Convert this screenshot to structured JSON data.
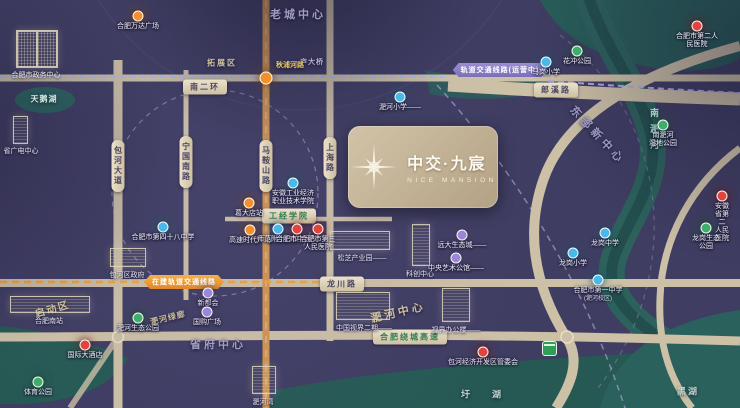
{
  "project": {
    "name_cn": "中交·九宸",
    "name_en": "NICE MANSION"
  },
  "colors": {
    "background": "#3F3D62",
    "road": "#CCC0A6",
    "metro_road": "#D2954E",
    "river": "#2C615C",
    "school": "#4AB8E8",
    "hospital": "#E0443C",
    "park": "#3FAE6A",
    "metro": "#F2912C",
    "commerce": "#9B86D8",
    "mall": "#F2912C",
    "hotel": "#E0443C",
    "logo_bg": "#C4B497"
  },
  "district_labels": [
    {
      "text": "老城中心",
      "x": 298,
      "y": 14,
      "size": 11,
      "ls": 3,
      "color": "#A39DC6",
      "rot": 0
    },
    {
      "text": "拓展区",
      "x": 222,
      "y": 63,
      "size": 8,
      "ls": 2,
      "color": "#CFC49F",
      "rot": 0
    },
    {
      "text": "东部新中心",
      "x": 598,
      "y": 135,
      "size": 11,
      "ls": 4,
      "color": "#9B98C2",
      "rot": 47
    },
    {
      "text": "省府中心",
      "x": 218,
      "y": 344,
      "size": 11,
      "ls": 3,
      "color": "#A39DC6",
      "rot": 0
    },
    {
      "text": "淝河中心",
      "x": 398,
      "y": 312,
      "size": 11,
      "ls": 3,
      "color": "#CDBE9A",
      "rot": -13
    },
    {
      "text": "启动区",
      "x": 52,
      "y": 308,
      "size": 10,
      "ls": 2,
      "color": "#CDBE9A",
      "rot": -16
    },
    {
      "text": "淝河绿廊",
      "x": 168,
      "y": 318,
      "size": 8,
      "ls": 1,
      "color": "#CBBD99",
      "rot": -14
    },
    {
      "text": "天鹅湖",
      "x": 44,
      "y": 99,
      "size": 8,
      "ls": 1,
      "color": "#D6EFE6",
      "rot": 0
    },
    {
      "text": "圩湖",
      "x": 492,
      "y": 394,
      "size": 9,
      "ls": 22,
      "color": "#BFD8CE",
      "rot": 0
    },
    {
      "text": "黑湖",
      "x": 688,
      "y": 391,
      "size": 9,
      "ls": 2,
      "color": "#BFD8CE",
      "rot": 0
    },
    {
      "text": "庐大桥",
      "x": 312,
      "y": 62,
      "size": 7,
      "ls": 1,
      "color": "#B7B0D0",
      "rot": 0
    },
    {
      "text": "秋浦河路",
      "x": 290,
      "y": 65,
      "size": 7,
      "ls": 0,
      "color": "#ECC95F",
      "rot": 0
    }
  ],
  "vertical_labels": [
    {
      "text": "南淝河",
      "x": 648,
      "y": 108,
      "size": 9,
      "ls": 7,
      "color": "#A8D8CC"
    }
  ],
  "road_pills": [
    {
      "text": "南二环",
      "x": 205,
      "y": 87,
      "style": "beige"
    },
    {
      "text": "郎溪路",
      "x": 556,
      "y": 90,
      "style": "beige"
    },
    {
      "text": "龙川路",
      "x": 342,
      "y": 284,
      "style": "beige"
    },
    {
      "text": "工经学院",
      "x": 289,
      "y": 216,
      "style": "green"
    },
    {
      "text": "合肥绕城高速",
      "x": 410,
      "y": 337,
      "style": "green"
    }
  ],
  "vertical_road_pills": [
    {
      "text": "包河大道",
      "x": 118,
      "y": 166
    },
    {
      "text": "宁国南路",
      "x": 186,
      "y": 162
    },
    {
      "text": "马鞍山路",
      "x": 266,
      "y": 166
    },
    {
      "text": "上海路",
      "x": 330,
      "y": 158
    }
  ],
  "metro_pills": [
    {
      "text": "轨道交通线路(运营中)",
      "x": 500,
      "y": 70,
      "style": "purple"
    },
    {
      "text": "在建轨道交通线路",
      "x": 184,
      "y": 282,
      "style": "orange"
    }
  ],
  "buildings": [
    {
      "label": "合肥市政务中心",
      "x": 16,
      "y": 30,
      "w": 40,
      "h": 36,
      "shape": "pair",
      "lx": 36,
      "ly": 70
    },
    {
      "label": "省广电中心",
      "x": 13,
      "y": 116,
      "w": 13,
      "h": 26,
      "shape": "tower",
      "lx": 21,
      "ly": 146
    },
    {
      "label": "合肥南站",
      "x": 10,
      "y": 296,
      "w": 78,
      "h": 15,
      "shape": "wide",
      "lx": 49,
      "ly": 316
    },
    {
      "label": "包河区政府",
      "x": 110,
      "y": 248,
      "w": 34,
      "h": 17,
      "shape": "block",
      "lx": 127,
      "ly": 270
    },
    {
      "label": "松芝产业园——",
      "x": 330,
      "y": 231,
      "w": 58,
      "h": 17,
      "shape": "wide",
      "lx": 362,
      "ly": 253
    },
    {
      "label": "科创中心",
      "x": 412,
      "y": 224,
      "w": 16,
      "h": 40,
      "shape": "tower",
      "lx": 420,
      "ly": 269
    },
    {
      "label": "中国视界二期——",
      "x": 336,
      "y": 292,
      "w": 52,
      "h": 26,
      "shape": "block",
      "lx": 364,
      "ly": 323
    },
    {
      "label": "视界办公楼——",
      "x": 442,
      "y": 288,
      "w": 26,
      "h": 32,
      "shape": "tower",
      "lx": 456,
      "ly": 325
    },
    {
      "label": "淝河湾",
      "x": 252,
      "y": 366,
      "w": 22,
      "h": 26,
      "shape": "tower",
      "lx": 263,
      "ly": 397
    }
  ],
  "pois": [
    {
      "type": "mall",
      "x": 138,
      "y": 16,
      "label": "合肥万达广场"
    },
    {
      "type": "metro",
      "x": 266,
      "y": 78,
      "label": ""
    },
    {
      "type": "metro",
      "x": 249,
      "y": 203,
      "label": "葛大店站"
    },
    {
      "type": "mall",
      "x": 250,
      "y": 230,
      "label": "高速时代广场"
    },
    {
      "type": "school",
      "x": 163,
      "y": 227,
      "label": "合肥市第四十八中学"
    },
    {
      "type": "school",
      "x": 293,
      "y": 183,
      "label": "安徽工业经济\n职业技术学院"
    },
    {
      "type": "school",
      "x": 278,
      "y": 229,
      "label": "师范附小分校"
    },
    {
      "type": "hospital",
      "x": 297,
      "y": 229,
      "label": "合肥市中医院"
    },
    {
      "type": "hospital",
      "x": 318,
      "y": 229,
      "label": "合肥市第三\n人民医院"
    },
    {
      "type": "school",
      "x": 400,
      "y": 97,
      "label": "淝河小学——"
    },
    {
      "type": "school",
      "x": 546,
      "y": 62,
      "label": "马岗小学"
    },
    {
      "type": "park",
      "x": 577,
      "y": 51,
      "label": "花冲公园"
    },
    {
      "type": "hospital",
      "x": 697,
      "y": 26,
      "label": "合肥市第二人民医院"
    },
    {
      "type": "park",
      "x": 663,
      "y": 125,
      "label": "南淝河\n湿地公园"
    },
    {
      "type": "hospital",
      "x": 722,
      "y": 196,
      "label": "安徽省第二\n人民医院"
    },
    {
      "type": "park",
      "x": 706,
      "y": 228,
      "label": "龙岗生态公园"
    },
    {
      "type": "school",
      "x": 605,
      "y": 233,
      "label": "龙岗中学"
    },
    {
      "type": "school",
      "x": 573,
      "y": 253,
      "label": "龙岗小学"
    },
    {
      "type": "school",
      "x": 598,
      "y": 280,
      "label": "合肥市第一中学",
      "sub": "(淝河校区)"
    },
    {
      "type": "hospital",
      "x": 483,
      "y": 352,
      "label": "包河经济开发区管委会"
    },
    {
      "type": "hotel",
      "x": 85,
      "y": 345,
      "label": "国际大酒店"
    },
    {
      "type": "park",
      "x": 138,
      "y": 318,
      "label": "淝河生态公园"
    },
    {
      "type": "park",
      "x": 38,
      "y": 382,
      "label": "体育公园"
    },
    {
      "type": "commerce",
      "x": 208,
      "y": 293,
      "label": "新都会"
    },
    {
      "type": "commerce",
      "x": 207,
      "y": 312,
      "label": "国购广场"
    },
    {
      "type": "commerce",
      "x": 462,
      "y": 235,
      "label": "远大生态城——"
    },
    {
      "type": "commerce",
      "x": 456,
      "y": 258,
      "label": "中央艺术公馆——"
    }
  ]
}
